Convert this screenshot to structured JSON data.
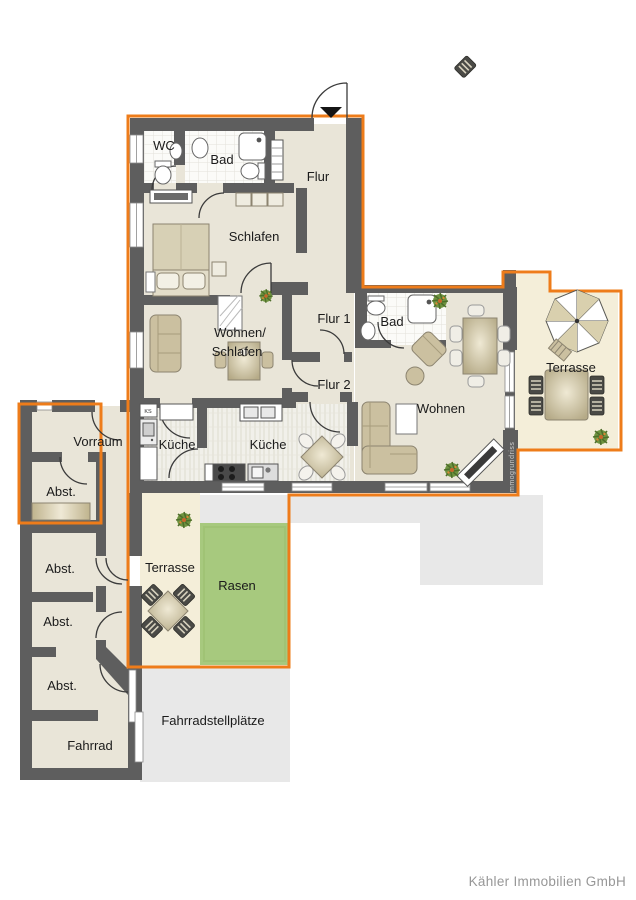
{
  "rooms": {
    "wc": "WC",
    "bad_top": "Bad",
    "flur": "Flur",
    "schlafen": "Schlafen",
    "wohnen_schlafen_line1": "Wohnen/",
    "wohnen_schlafen_line2": "Schlafen",
    "flur1": "Flur 1",
    "flur2": "Flur 2",
    "bad_right": "Bad",
    "wohnen": "Wohnen",
    "terrasse_right": "Terrasse",
    "kueche_left": "Küche",
    "kueche_right": "Küche",
    "vorraum": "Vorraum",
    "abst1": "Abst.",
    "abst2": "Abst.",
    "abst3": "Abst.",
    "abst4": "Abst.",
    "fahrrad": "Fahrrad",
    "terrasse_bottom": "Terrasse",
    "rasen": "Rasen",
    "fahrradstellplaetze": "Fahrradstellplätze",
    "ks_unit": "KS"
  },
  "watermark": "mmogrundriss",
  "footer": {
    "company": "Kähler Immobilien GmbH"
  },
  "colors": {
    "boundary_orange": "#EE7C1A",
    "wall_gray": "#5E5E5E",
    "floor_beige": "#E9E5D8",
    "terrace_cream": "#F4EED9",
    "lawn_green": "#A7C97E",
    "paving_gray": "#E8E8E8"
  }
}
